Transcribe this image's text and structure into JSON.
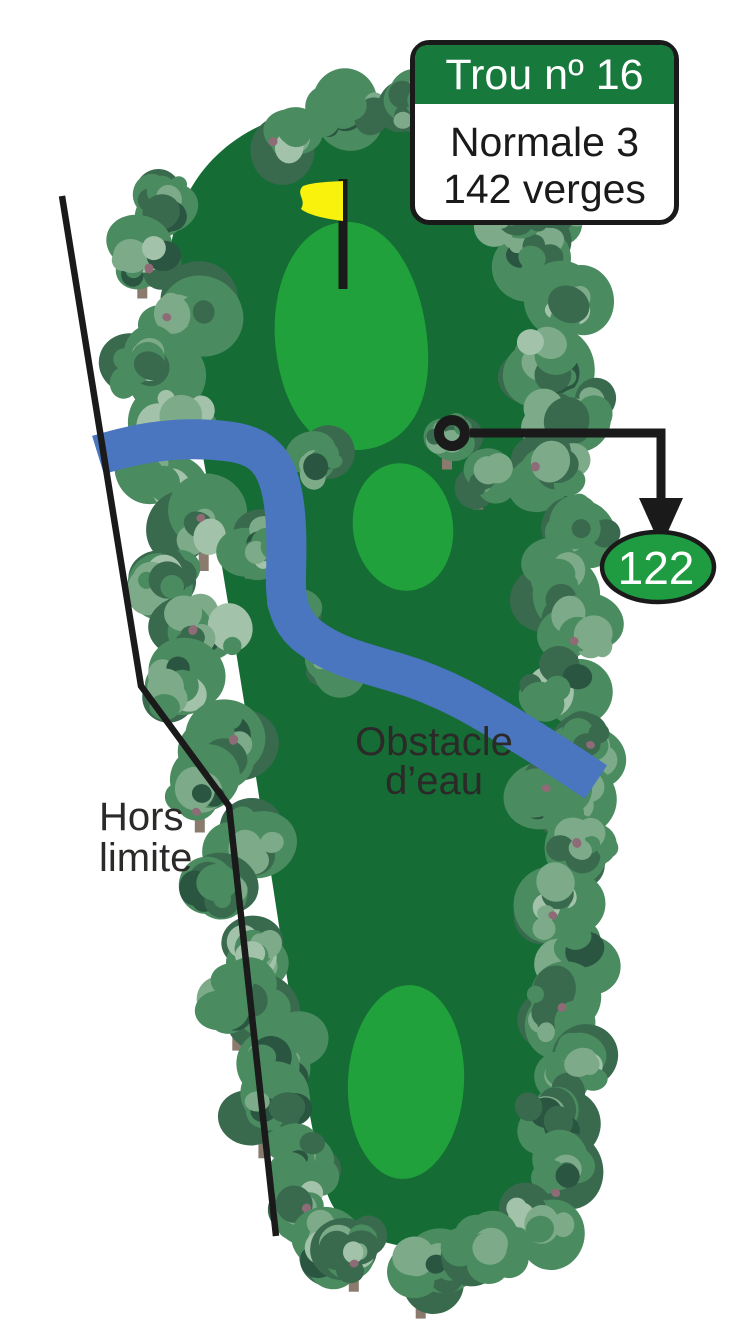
{
  "sign": {
    "title": "Trou nº 16",
    "par": "Normale 3",
    "distance": "142 verges"
  },
  "labels": {
    "out_of_bounds_line1": "Hors",
    "out_of_bounds_line2": "limite",
    "water_hazard_line1": "Obstacle",
    "water_hazard_line2": "d’eau"
  },
  "marker": {
    "distance": "122"
  },
  "colors": {
    "background": "#ffffff",
    "fairway": "#156c35",
    "zone": "#21a13c",
    "water": "#4a75bf",
    "sign_green": "#17793c",
    "marker_green": "#1f9c41",
    "flag_yellow": "#f8f20c",
    "ink": "#1a1a1a",
    "label_ink": "#2b2a28",
    "tree_base": "#4b8b60",
    "tree_light": "#7dab89",
    "tree_pale": "#a3c2aa",
    "tree_dark": "#396a4e",
    "tree_deep": "#2a5540",
    "tree_trunk": "#8a7b6e",
    "tree_berry": "#8e6b76"
  }
}
